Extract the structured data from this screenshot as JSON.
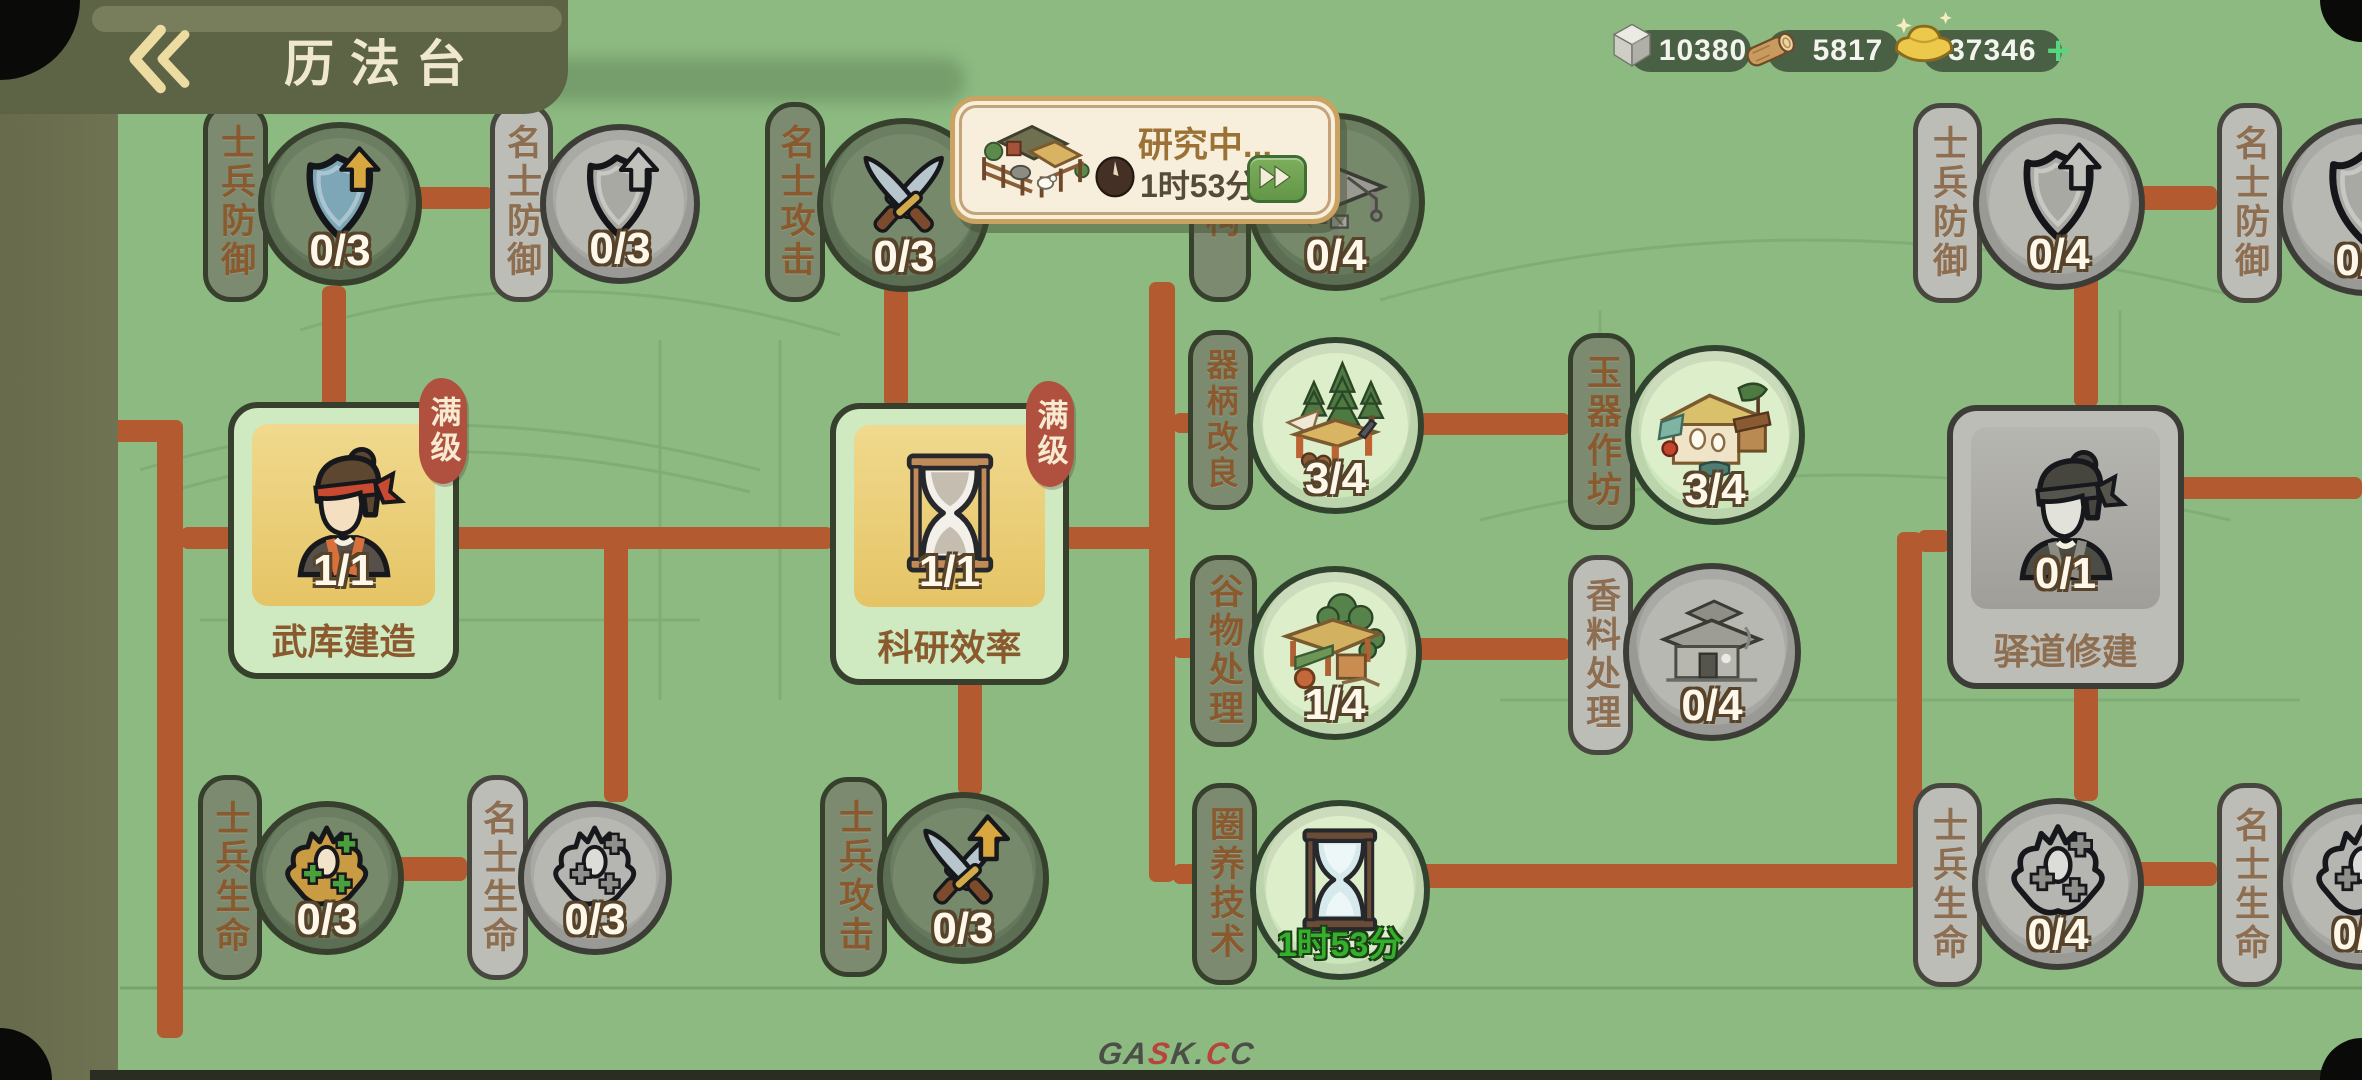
{
  "header": {
    "title": "历法台"
  },
  "resources": {
    "stone": {
      "icon": "stone-icon",
      "value": "10380"
    },
    "wood": {
      "icon": "wood-log-icon",
      "value": "5817"
    },
    "gold": {
      "icon": "gold-ingot-icon",
      "value": "37346",
      "add_label": "+"
    }
  },
  "research_popup": {
    "title": "研究中...",
    "time_remaining": "1时53分",
    "building_icon": "livestock-pen-building",
    "clock_icon": "clock-icon",
    "fast_forward_icon": "double-chevron-right"
  },
  "nodes": [
    {
      "id": "soldier-defense-left",
      "label": "士兵防御",
      "count": "0/3",
      "state": "available",
      "icon": "shield-up-icon"
    },
    {
      "id": "scholar-defense-left",
      "label": "名士防御",
      "count": "0/3",
      "state": "locked",
      "icon": "shield-up-icon"
    },
    {
      "id": "scholar-attack",
      "label": "名士攻击",
      "count": "0/3",
      "state": "available",
      "icon": "crossed-swords-icon"
    },
    {
      "id": "structure",
      "label": "结构",
      "count": "0/4",
      "state": "available",
      "icon": "cart-structure-building"
    },
    {
      "id": "armory-construction",
      "label": "武库建造",
      "count": "1/1",
      "state": "maxed",
      "badge": "满级",
      "icon": "artisan-portrait"
    },
    {
      "id": "research-efficiency",
      "label": "科研效率",
      "count": "1/1",
      "state": "maxed",
      "badge": "满级",
      "icon": "hourglass-icon"
    },
    {
      "id": "tool-handle-improvement",
      "label": "器柄改良",
      "count": "3/4",
      "state": "researched",
      "icon": "lumber-camp-building"
    },
    {
      "id": "jade-workshop",
      "label": "玉器作坊",
      "count": "3/4",
      "state": "researched",
      "icon": "jade-workshop-building"
    },
    {
      "id": "grain-processing",
      "label": "谷物处理",
      "count": "1/4",
      "state": "researched",
      "icon": "grain-shed-building"
    },
    {
      "id": "spice-processing",
      "label": "香料处理",
      "count": "0/4",
      "state": "locked",
      "icon": "spice-house-building"
    },
    {
      "id": "pen-raising-tech",
      "label": "圈养技术",
      "time": "1时53分",
      "state": "researching",
      "icon": "hourglass-icon"
    },
    {
      "id": "post-road-construction",
      "label": "驿道修建",
      "count": "0/1",
      "state": "locked",
      "icon": "worker-portrait"
    },
    {
      "id": "soldier-defense-right",
      "label": "士兵防御",
      "count": "0/4",
      "state": "locked",
      "icon": "shield-up-icon"
    },
    {
      "id": "scholar-defense-right",
      "label": "名士防御",
      "count": "0/4",
      "state": "locked",
      "icon": "shield-up-icon"
    },
    {
      "id": "soldier-life-left",
      "label": "士兵生命",
      "count": "0/3",
      "state": "available",
      "icon": "muscle-plus-icon"
    },
    {
      "id": "scholar-life-left",
      "label": "名士生命",
      "count": "0/3",
      "state": "locked",
      "icon": "muscle-plus-icon"
    },
    {
      "id": "soldier-attack",
      "label": "士兵攻击",
      "count": "0/3",
      "state": "available",
      "icon": "crossed-swords-up-icon"
    },
    {
      "id": "soldier-life-right",
      "label": "士兵生命",
      "count": "0/4",
      "state": "locked",
      "icon": "muscle-plus-icon"
    },
    {
      "id": "scholar-life-right",
      "label": "名士生命",
      "count": "0/4",
      "state": "locked",
      "icon": "muscle-plus-icon"
    }
  ],
  "watermark": {
    "parts": [
      {
        "text": "GA"
      },
      {
        "text": "S"
      },
      {
        "text": "K."
      },
      {
        "text": "C"
      },
      {
        "text": "C"
      }
    ]
  },
  "colors": {
    "background_green": "#8cba81",
    "connector_orange": "#b35a31",
    "header_olive": "#5d6345",
    "badge_red": "#b05140",
    "popup_cream": "#f7efdc",
    "research_time_green": "#35b02c",
    "count_text": "#fdf8ea",
    "label_text_brown": "#8a5a2e"
  }
}
